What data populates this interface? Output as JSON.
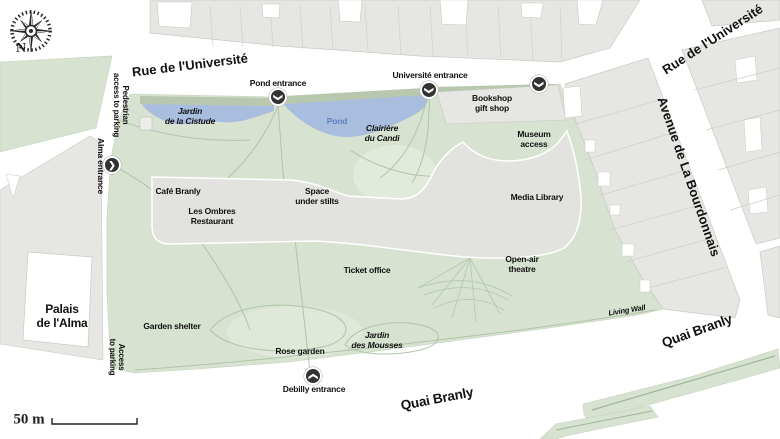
{
  "streets": {
    "rue_universite_left": "Rue de l'Université",
    "rue_universite_right": "Rue de l'Université",
    "avenue_bourdonnais": "Avenue de La Bourdonnais",
    "quai_branly_bottom": "Quai Branly",
    "quai_branly_right": "Quai Branly"
  },
  "entrances": {
    "pond": "Pond entrance",
    "universite": "Université entrance",
    "alma": "Alma entrance",
    "debilly": "Debilly entrance"
  },
  "access": {
    "pedestrian_parking": "Pedestrian\naccess to parking",
    "access_parking": "Access\nto parking"
  },
  "facilities": {
    "bookshop": "Bookshop\ngift shop",
    "museum_access": "Museum\naccess",
    "media_library": "Media Library",
    "cafe_branly": "Café Branly",
    "les_ombres": "Les Ombres\nRestaurant",
    "space_under_stilts": "Space\nunder stilts",
    "ticket_office": "Ticket office",
    "open_air_theatre": "Open-air\ntheatre",
    "living_wall": "Living Wall",
    "palais_alma": "Palais\nde l'Alma"
  },
  "garden_areas": {
    "jardin_cistude": "Jardin\nde la Cistude",
    "clairiere_candi": "Clairière\ndu Candi",
    "pond": "Pond",
    "garden_shelter": "Garden shelter",
    "rose_garden": "Rose garden",
    "jardin_mousses": "Jardin\ndes Mousses"
  },
  "compass": {
    "north": "N"
  },
  "scale": {
    "label": "50 m"
  },
  "icons": {
    "chevron": "❯"
  },
  "colors": {
    "garden": "#d8e2d1",
    "hedge": "#b7c8ae",
    "pond": "#a9bdde",
    "pond_text": "#5f80c0",
    "building": "#e6e6e3",
    "museum": "#e2e2df",
    "path": "#aec5a7",
    "entrance_bg": "#333333"
  }
}
